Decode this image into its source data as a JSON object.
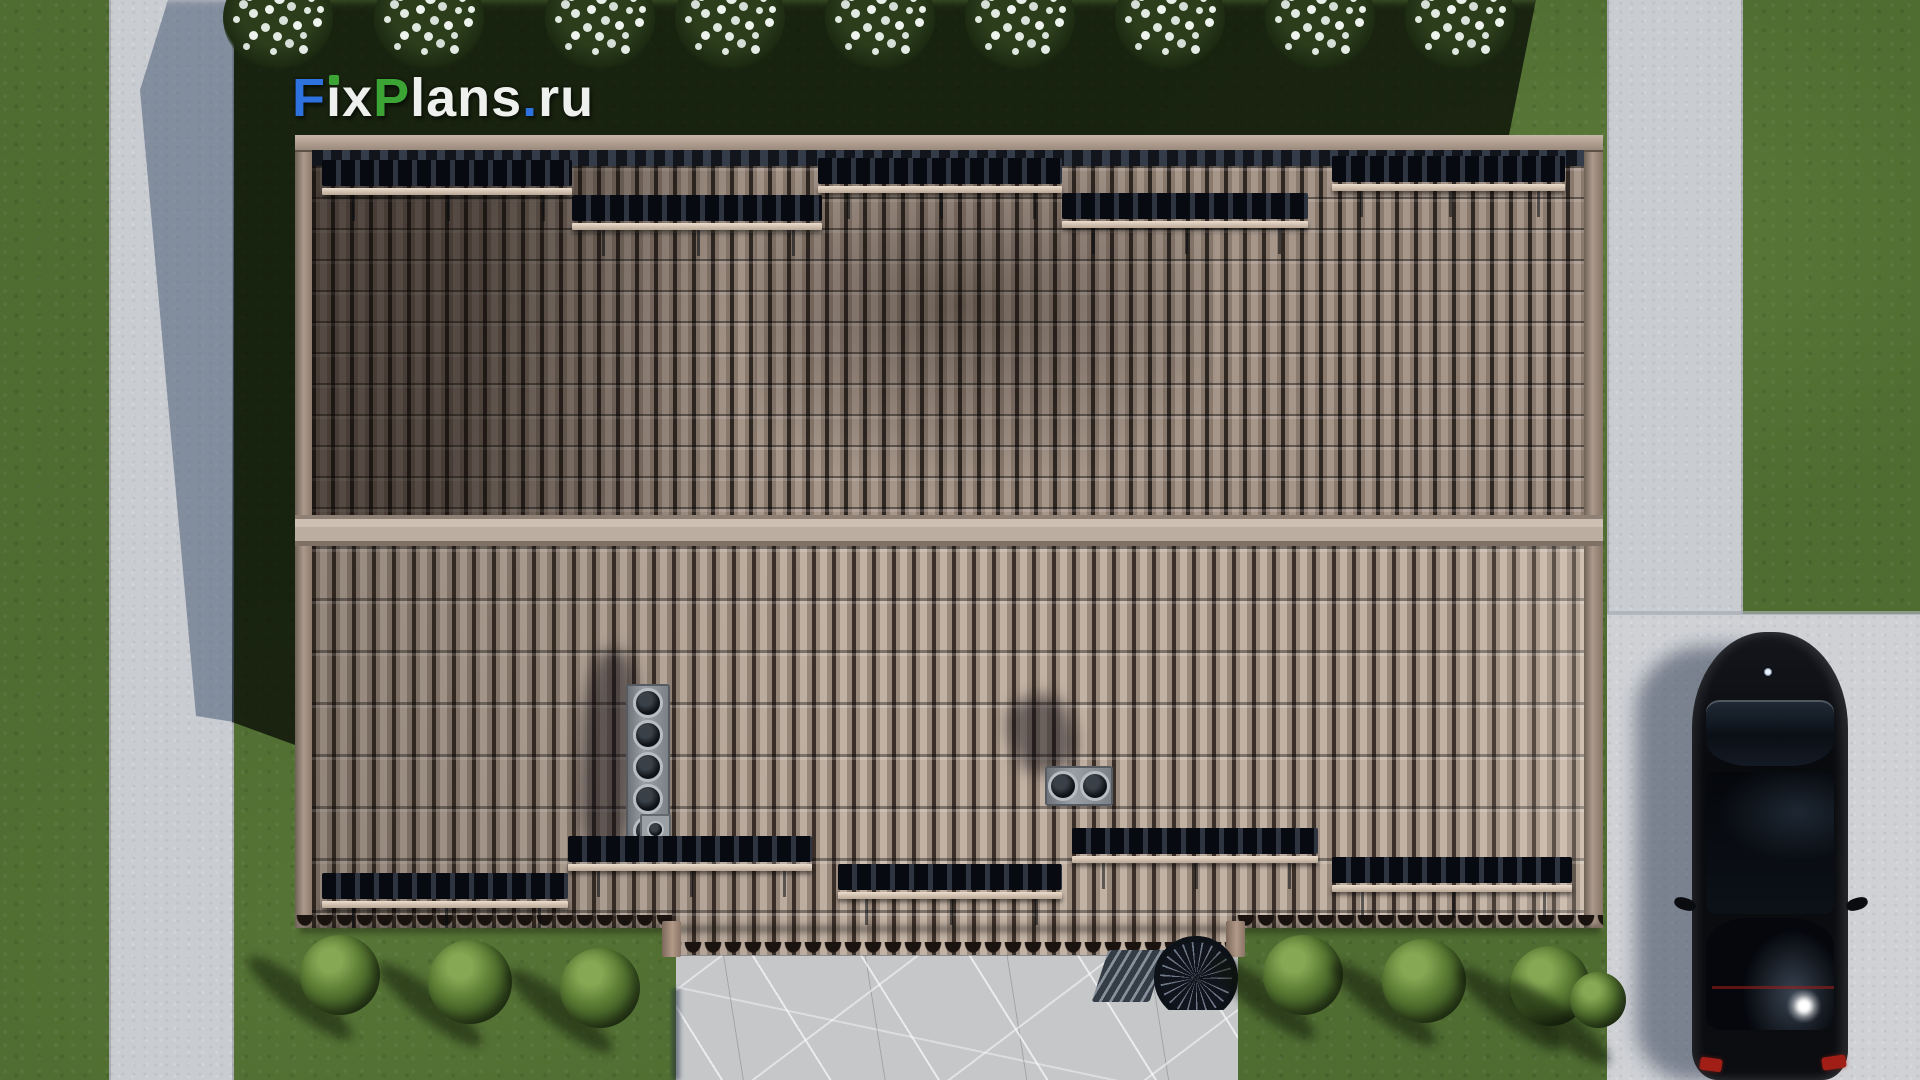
{
  "watermark": {
    "text": "FixPlans.ru",
    "parts": [
      {
        "text": "F",
        "color": "#2e72e0"
      },
      {
        "text": "i",
        "color": "#eef0ee",
        "dot_color": "#3ba435"
      },
      {
        "text": "x",
        "color": "#eef0ee"
      },
      {
        "text": "P",
        "color": "#3ba435"
      },
      {
        "text": "lans",
        "color": "#eef0ee"
      },
      {
        "text": ".",
        "color": "#2e72e0"
      },
      {
        "text": "ru",
        "color": "#eef0ee"
      }
    ]
  },
  "palette": {
    "grass": "#4f6c31",
    "grass_dark": "#18260f",
    "path": "#c9ccd1",
    "path_shadow": "#7f8da0",
    "driveway": "#cfd1d5",
    "patio": "#c5c7c9",
    "roof_tile": "#a6968a",
    "roof_tile_light": "#c2b2a4",
    "roof_gap": "#362c25",
    "ridge": "#bcada1",
    "fascia": "#9b8878",
    "rail": "#dccdbd",
    "car": "#0b0d11",
    "taillight": "#a01e16",
    "bush": "#5a7c33",
    "flower": "#e6ece6"
  },
  "scene": {
    "description": "Top-down 3D render of a house with a brown tiled gable roof, lawn, concrete walkways, stone patio with spiral staircase, driveway with parked black car",
    "counts": {
      "snow_guards_upper_slope": 5,
      "snow_guards_lower_slope": 5,
      "chimney_large_pipes": 5,
      "chimney_small_pipes": 2,
      "flowering_shrubs_top": 9,
      "garden_bushes_bottom": 7,
      "cars": 1
    }
  }
}
